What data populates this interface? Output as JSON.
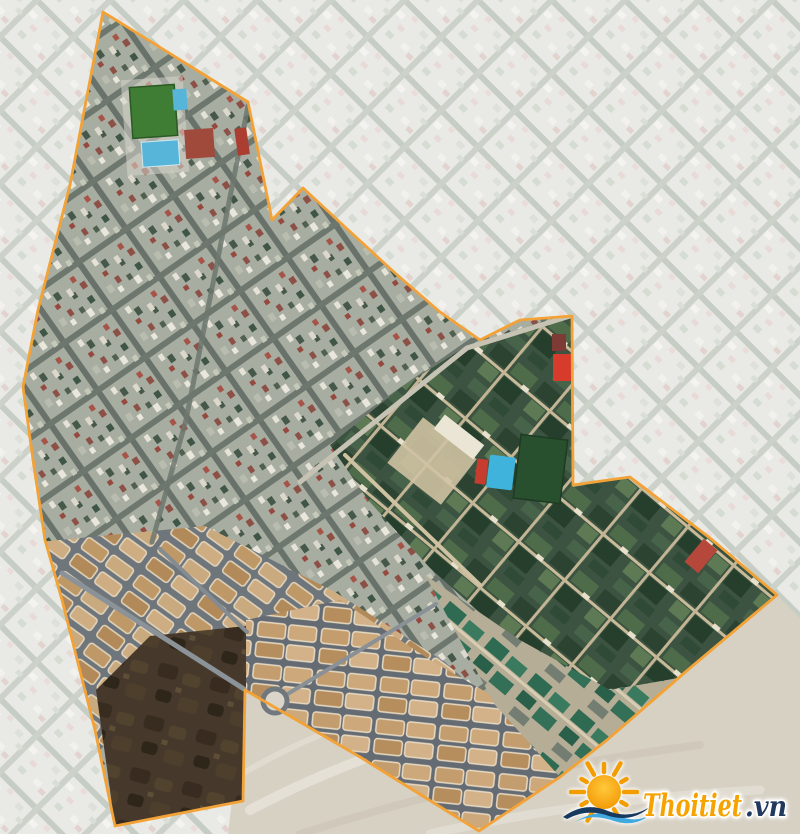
{
  "map": {
    "boundary_color": "#f2a237",
    "palette": {
      "faded_city": "#e9eae6",
      "urban_inside": "#a8ada1",
      "campus_green": "#3b5340",
      "development_tan": "#c19a6b",
      "soil_dark": "#46392b",
      "sand": "#d7d1c4",
      "pool_blue": "#52b4d8",
      "field_green": "#3f7c34"
    }
  },
  "watermark": {
    "brand": "Thoitiet",
    "tld": ".vn",
    "brand_color": "#f6a300",
    "tld_color": "#21395d"
  }
}
